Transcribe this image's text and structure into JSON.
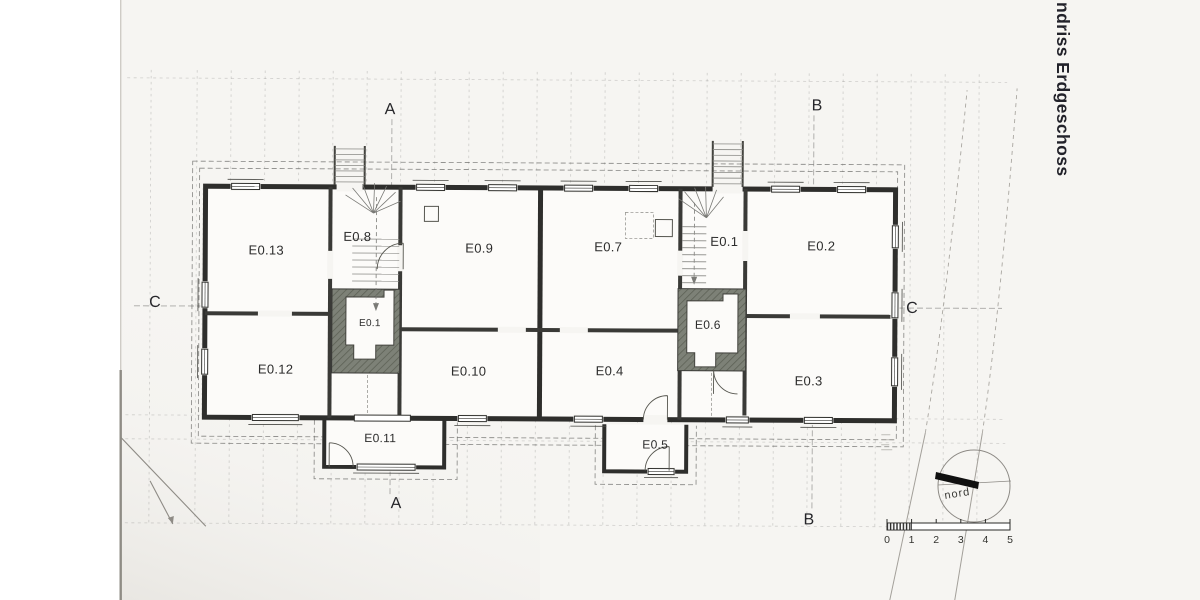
{
  "page": {
    "title": "ndriss Erdgeschoss"
  },
  "plan": {
    "rooms": [
      {
        "label": "E0.13"
      },
      {
        "label": "E0.8"
      },
      {
        "label": "E0.9"
      },
      {
        "label": "E0.7"
      },
      {
        "label": "E0.1"
      },
      {
        "label": "E0.2"
      },
      {
        "label": "E0.12"
      },
      {
        "label": "E0.1"
      },
      {
        "label": "E0.10"
      },
      {
        "label": "E0.4"
      },
      {
        "label": "E0.6"
      },
      {
        "label": "E0.3"
      },
      {
        "label": "E0.11"
      },
      {
        "label": "E0.5"
      }
    ],
    "section_markers": {
      "a": "A",
      "b": "B",
      "c": "C"
    },
    "compass": {
      "label": "nord"
    },
    "scale_bar": {
      "ticks": [
        "0",
        "1",
        "2",
        "3",
        "4",
        "5"
      ]
    }
  },
  "colors": {
    "page": "#f6f5f2",
    "scan_margin": "#ffffff",
    "wall": "#2e2e2c",
    "chimney_fill": "#7d8177",
    "title_text": "#22222a",
    "north_bar": "#101010"
  }
}
